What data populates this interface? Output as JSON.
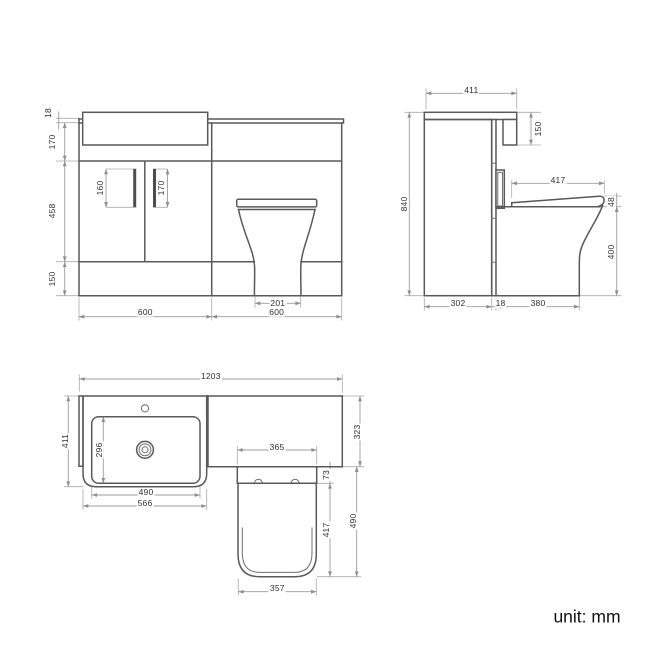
{
  "front": {
    "worktop_edge": "18",
    "apron_height": "170",
    "door_height": "458",
    "plinth_height": "150",
    "left_handle_length": "160",
    "right_handle_length": "170",
    "pan_base_width": "201",
    "vanity_width": "600",
    "wc_width": "600"
  },
  "side": {
    "worktop_depth": "411",
    "worktop_drop": "150",
    "total_height": "840",
    "seat_length": "417",
    "seat_thickness": "48",
    "pan_height": "400",
    "cabinet_depth": "302",
    "panel_thickness": "18",
    "pan_projection": "380"
  },
  "plan": {
    "total_width": "1203",
    "basin_depth": "411",
    "bowl_depth": "296",
    "bowl_width": "490",
    "basin_width": "566",
    "wc_top_depth": "323",
    "recess_width": "365",
    "seat_setback": "73",
    "seat_length": "417",
    "pan_projection": "490",
    "seat_width": "357"
  },
  "footer": {
    "unit_label": "unit: mm"
  },
  "colors": {
    "object_line": "#595959",
    "dimension_line": "#9c9c9c",
    "label_text": "#2f2f2f",
    "background": "#ffffff"
  }
}
